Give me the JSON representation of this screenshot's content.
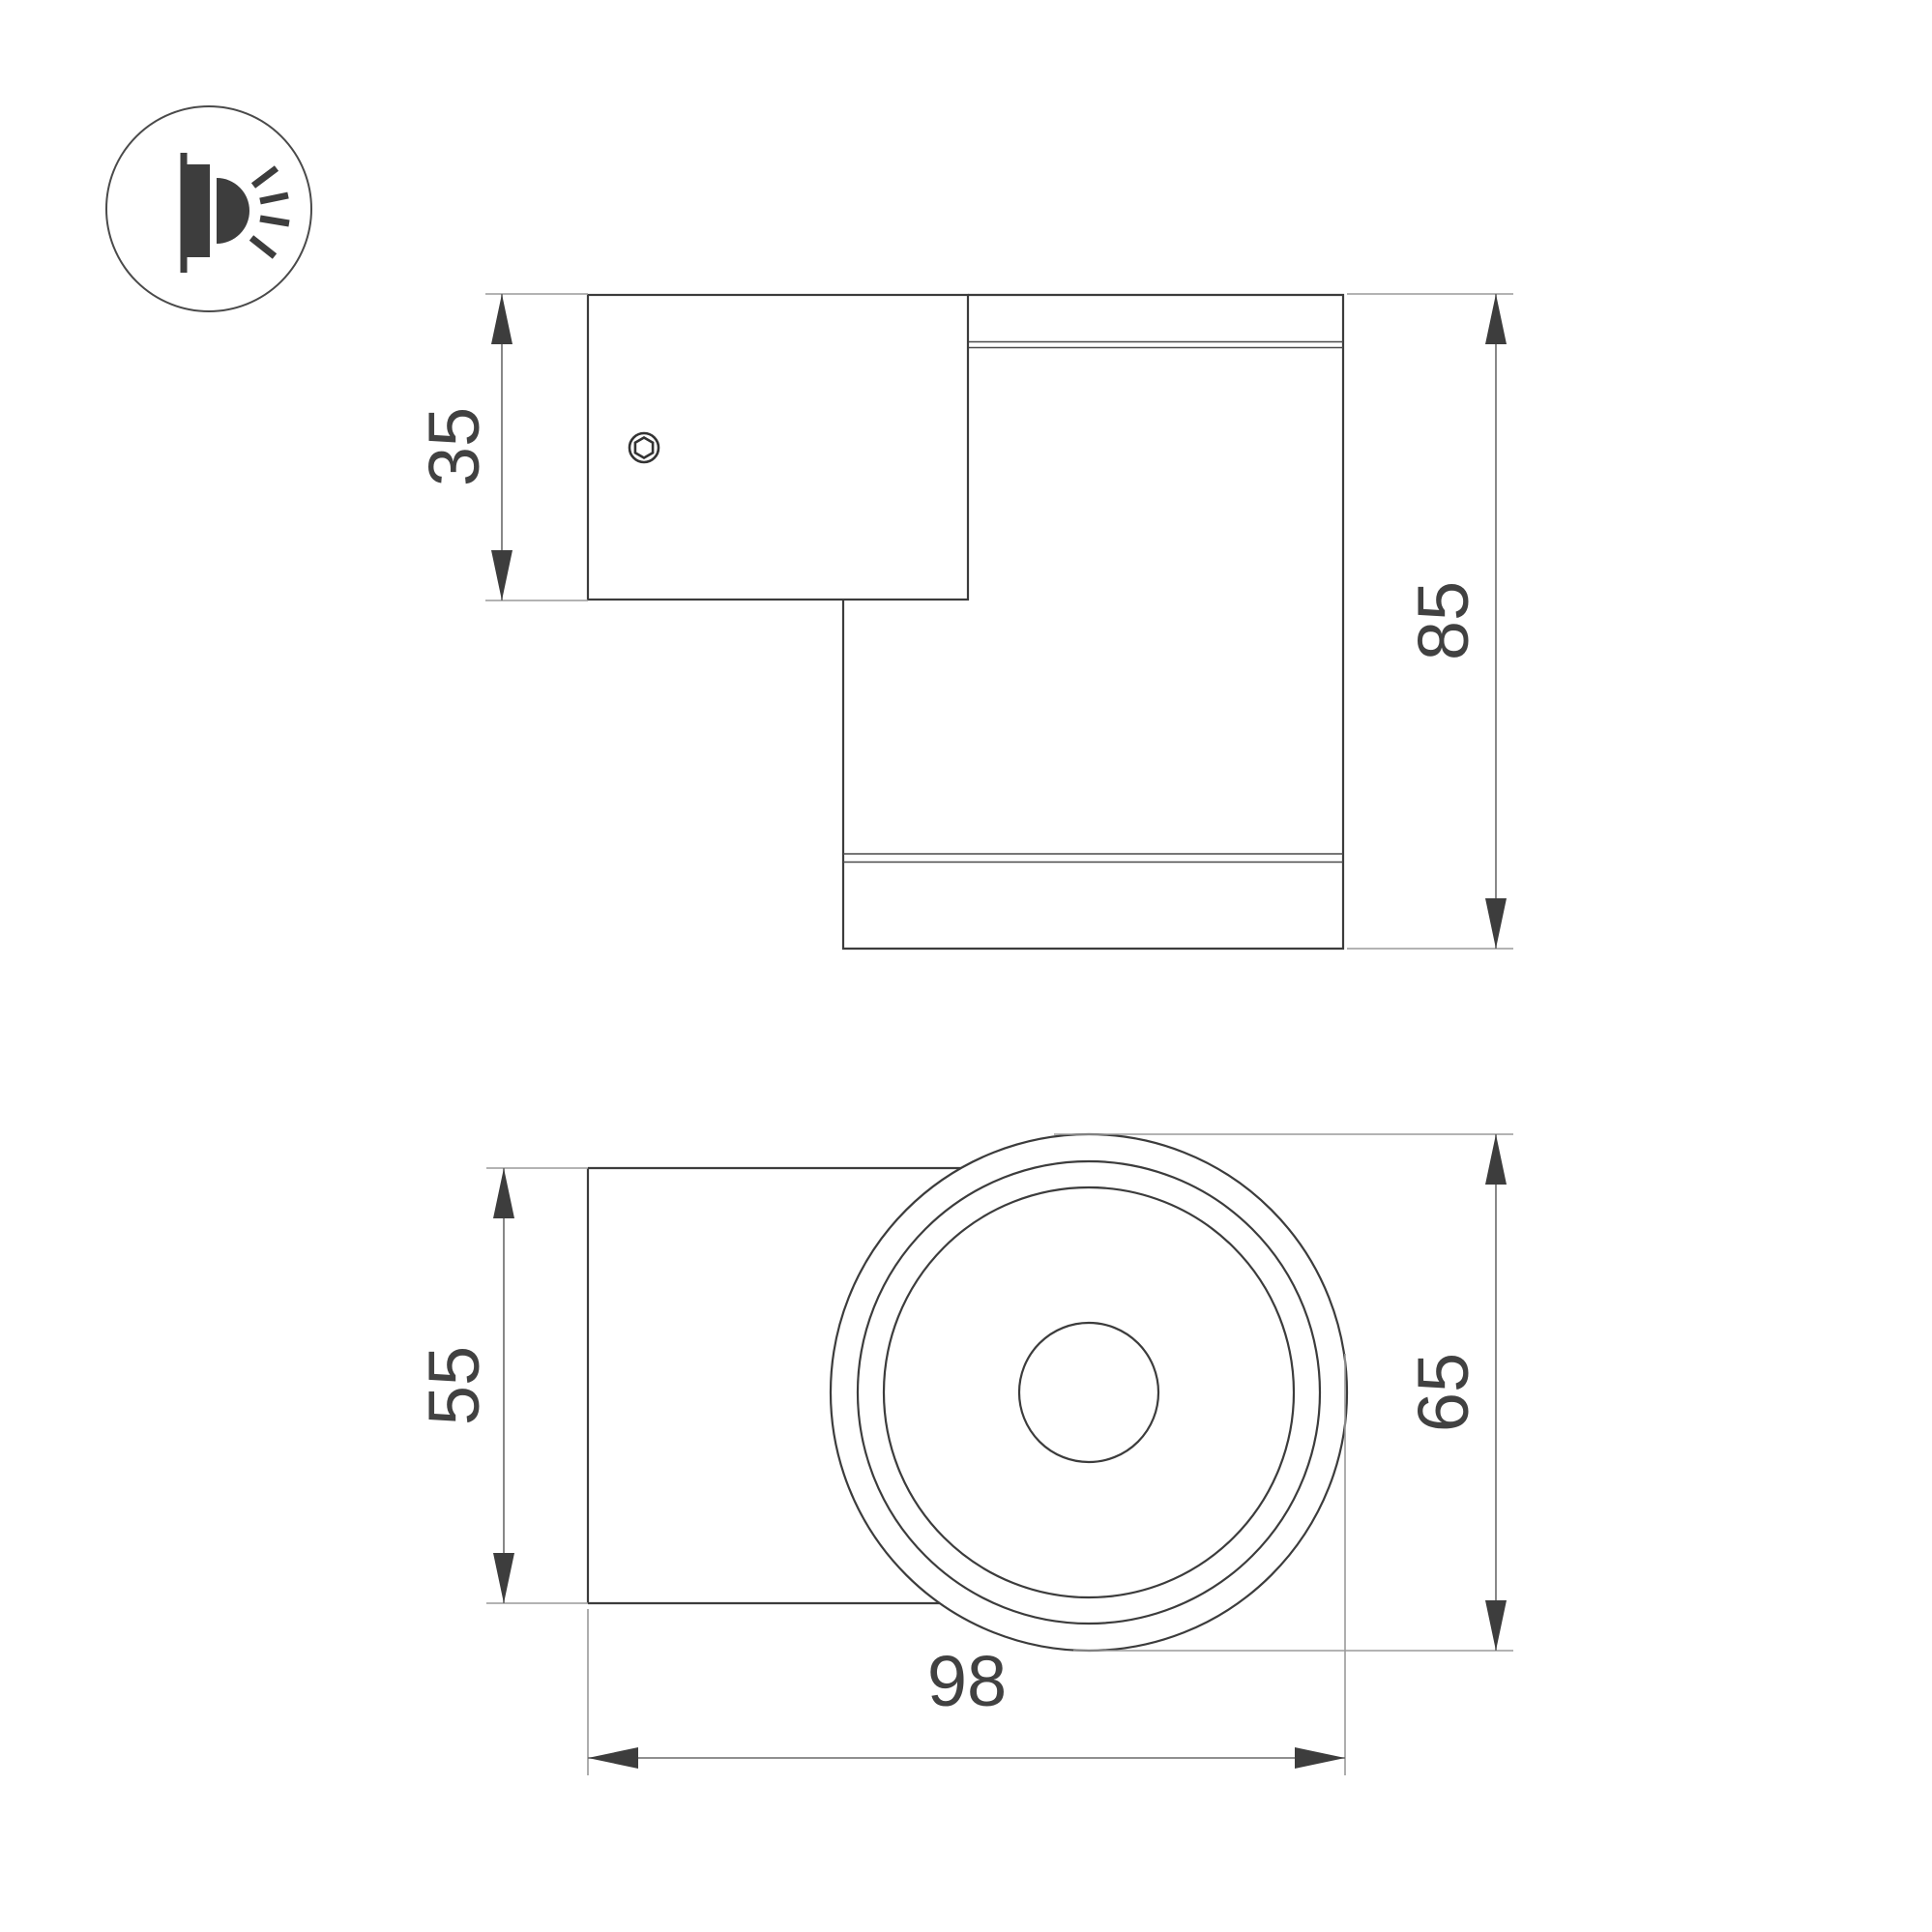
{
  "page": {
    "background": "#ffffff",
    "type": "technical-dimension-drawing"
  },
  "icon": {
    "name": "wall-mounted-light-icon"
  },
  "views": {
    "side_view": {
      "dimensions": {
        "plate_height": "35",
        "total_depth": "85"
      }
    },
    "front_view": {
      "dimensions": {
        "body_height": "55",
        "face_diameter": "65",
        "total_width": "98"
      }
    }
  },
  "colors": {
    "object_line": "#3c3c3c",
    "extension_line": "#9a9a9a",
    "dimension_line": "#6a6a6a",
    "arrow": "#3d3d3d",
    "text": "#414141"
  }
}
